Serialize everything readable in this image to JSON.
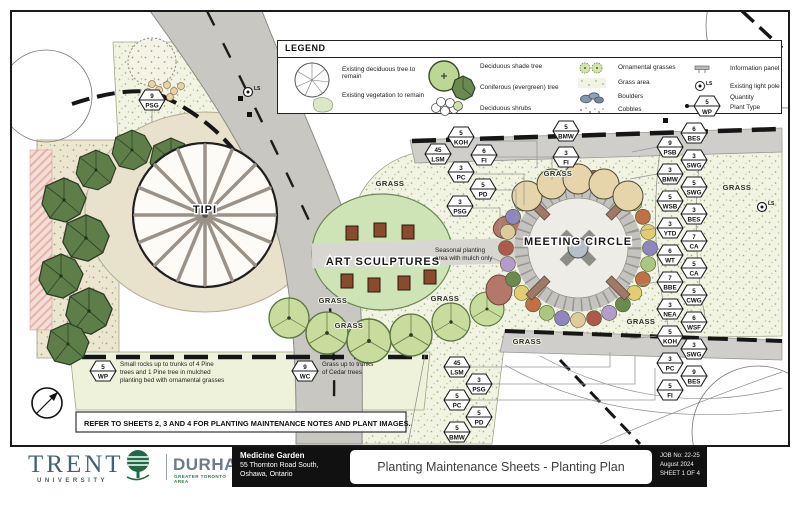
{
  "colors": {
    "bed_green": "#f1f4e2",
    "road_grey": "#c8c7c2",
    "path_grey": "#cfcecb",
    "plaza_tan": "#e8e1cc",
    "grass_green": "#cfe4b6",
    "conifer_green": "#5e7e49",
    "cedar_green": "#c8dc9e",
    "mulch_red": "#b4786b",
    "line_black": "#1a1a1a",
    "trent_slate": "#44616f",
    "durham_green": "#2e7d4f",
    "ring": [
      "#8f86c0",
      "#a9c77f",
      "#c07046",
      "#e2cd72",
      "#6b8a50",
      "#b39ccb",
      "#ad5a4a",
      "#dfca9a"
    ]
  },
  "legend": {
    "title": "LEGEND",
    "items": {
      "existing_tree": "Existing deciduous tree to remain",
      "existing_veg": "Existing vegetation to remain",
      "shade_tree": "Deciduous shade tree",
      "conifer": "Coniferous (evergreen) tree",
      "shrubs": "Deciduous shrubs",
      "orn_grasses": "Ornamental grasses",
      "grass_area": "Grass area",
      "boulders": "Boulders",
      "cobbles": "Cobbles",
      "info_panel": "Information panel",
      "light_pole": "Existing light pole",
      "quantity": "Quantity",
      "plant_type": "Plant Type"
    },
    "symbol": {
      "q": "5",
      "code": "WP",
      "ls": "LS"
    }
  },
  "plan": {
    "labels": {
      "tipi": "TIPI",
      "art": "ART SCULPTURES",
      "meeting": "MEETING CIRCLE"
    },
    "grass_text": "GRASS",
    "light_pole_label": "LS",
    "grass_labels": [
      [
        390,
        186
      ],
      [
        558,
        176
      ],
      [
        737,
        190
      ],
      [
        333,
        303
      ],
      [
        349,
        328
      ],
      [
        445,
        301
      ],
      [
        527,
        344
      ],
      [
        641,
        324
      ]
    ],
    "notes": {
      "seasonal": [
        "Seasonal planting",
        "area with mulch only"
      ],
      "wp": [
        "Small rocks up to trunks of 4 Pine",
        "trees and 1 Pine tree in mulched",
        "planting bed with ornamental grasses"
      ],
      "wc": [
        "Grass up to trunks",
        "of Cedar trees"
      ],
      "refer": "REFER TO SHEETS 2, 3 AND 4 FOR PLANTING MAINTENANCE NOTES AND PLANT IMAGES."
    },
    "tags": [
      {
        "x": 152,
        "y": 100,
        "q": "9",
        "c": "PSG"
      },
      {
        "x": 461,
        "y": 137,
        "q": "5",
        "c": "KOH"
      },
      {
        "x": 438,
        "y": 154,
        "q": "45",
        "c": "LSM"
      },
      {
        "x": 484,
        "y": 155,
        "q": "6",
        "c": "FI"
      },
      {
        "x": 461,
        "y": 172,
        "q": "3",
        "c": "PC"
      },
      {
        "x": 483,
        "y": 189,
        "q": "5",
        "c": "PD"
      },
      {
        "x": 460,
        "y": 206,
        "q": "3",
        "c": "PSG"
      },
      {
        "x": 566,
        "y": 131,
        "q": "5",
        "c": "BMW"
      },
      {
        "x": 566,
        "y": 157,
        "q": "3",
        "c": "FI"
      },
      {
        "x": 694,
        "y": 133,
        "q": "6",
        "c": "BES"
      },
      {
        "x": 670,
        "y": 147,
        "q": "9",
        "c": "PSB"
      },
      {
        "x": 694,
        "y": 160,
        "q": "3",
        "c": "SWG"
      },
      {
        "x": 670,
        "y": 174,
        "q": "3",
        "c": "BMW"
      },
      {
        "x": 694,
        "y": 187,
        "q": "5",
        "c": "SWG"
      },
      {
        "x": 670,
        "y": 201,
        "q": "5",
        "c": "WSB"
      },
      {
        "x": 694,
        "y": 214,
        "q": "3",
        "c": "BES"
      },
      {
        "x": 670,
        "y": 228,
        "q": "3",
        "c": "YTD"
      },
      {
        "x": 694,
        "y": 241,
        "q": "7",
        "c": "CA"
      },
      {
        "x": 670,
        "y": 255,
        "q": "6",
        "c": "WT"
      },
      {
        "x": 694,
        "y": 268,
        "q": "5",
        "c": "CA"
      },
      {
        "x": 670,
        "y": 282,
        "q": "7",
        "c": "BBE"
      },
      {
        "x": 694,
        "y": 295,
        "q": "5",
        "c": "CWG"
      },
      {
        "x": 670,
        "y": 309,
        "q": "3",
        "c": "NEA"
      },
      {
        "x": 694,
        "y": 322,
        "q": "6",
        "c": "WSF"
      },
      {
        "x": 670,
        "y": 336,
        "q": "5",
        "c": "KOH"
      },
      {
        "x": 694,
        "y": 349,
        "q": "3",
        "c": "SWG"
      },
      {
        "x": 670,
        "y": 363,
        "q": "3",
        "c": "PC"
      },
      {
        "x": 694,
        "y": 376,
        "q": "9",
        "c": "BES"
      },
      {
        "x": 670,
        "y": 390,
        "q": "5",
        "c": "FI"
      },
      {
        "x": 457,
        "y": 367,
        "q": "45",
        "c": "LSM"
      },
      {
        "x": 479,
        "y": 384,
        "q": "3",
        "c": "PSG"
      },
      {
        "x": 457,
        "y": 400,
        "q": "5",
        "c": "PC"
      },
      {
        "x": 479,
        "y": 417,
        "q": "5",
        "c": "PD"
      },
      {
        "x": 457,
        "y": 432,
        "q": "5",
        "c": "BMW"
      },
      {
        "x": 103,
        "y": 371,
        "q": "5",
        "c": "WP"
      },
      {
        "x": 305,
        "y": 371,
        "q": "9",
        "c": "WC"
      }
    ]
  },
  "titleblock": {
    "trent": {
      "name": "TRENT",
      "sub": "UNIVERSITY"
    },
    "durham": {
      "name": "DURHAM",
      "sub": "GREATER TORONTO AREA"
    },
    "project": [
      "Medicine Garden",
      "55 Thornton Road South,",
      "Oshawa, Ontario"
    ],
    "sheet_title": "Planting Maintenance Sheets - Planting Plan",
    "meta": [
      "JOB No: 22-25",
      "August 2024",
      "SHEET 1 OF 4"
    ],
    "firm": {
      "b": "B",
      "amp": "&",
      "a": "A"
    }
  }
}
